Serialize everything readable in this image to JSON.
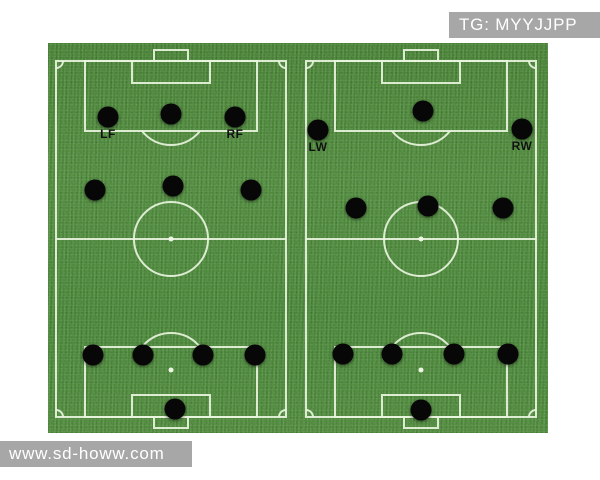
{
  "watermarks": {
    "top_right": "TG: MYYJJPP",
    "bottom_left": "www.sd-howw.com"
  },
  "colors": {
    "grass": "#4e8a3c",
    "pitch_line": "#e8f4dd",
    "player_dot": "#070707",
    "player_label": "#111111",
    "watermark_bg": "#a7a7a7",
    "watermark_text": "#ffffff"
  },
  "field": {
    "width": 500,
    "height": 390
  },
  "pitches": [
    {
      "id": "left",
      "name": "pitch-left-formation",
      "players": [
        {
          "role": "lf",
          "label": "LF",
          "x": 60,
          "y": 74
        },
        {
          "role": "cf",
          "x": 123,
          "y": 71
        },
        {
          "role": "rf",
          "label": "RF",
          "x": 187,
          "y": 74
        },
        {
          "role": "lm",
          "x": 47,
          "y": 147
        },
        {
          "role": "cm",
          "x": 125,
          "y": 143
        },
        {
          "role": "rm",
          "x": 203,
          "y": 147
        },
        {
          "role": "lb",
          "x": 45,
          "y": 312
        },
        {
          "role": "lcb",
          "x": 95,
          "y": 312
        },
        {
          "role": "rcb",
          "x": 155,
          "y": 312
        },
        {
          "role": "rb",
          "x": 207,
          "y": 312
        },
        {
          "role": "gk",
          "x": 127,
          "y": 366
        }
      ]
    },
    {
      "id": "right",
      "name": "pitch-right-formation",
      "players": [
        {
          "role": "lw",
          "label": "LW",
          "x": 270,
          "y": 87
        },
        {
          "role": "cf",
          "x": 375,
          "y": 68
        },
        {
          "role": "rw",
          "label": "RW",
          "x": 474,
          "y": 86
        },
        {
          "role": "lm",
          "x": 308,
          "y": 165
        },
        {
          "role": "cm",
          "x": 380,
          "y": 163
        },
        {
          "role": "rm",
          "x": 455,
          "y": 165
        },
        {
          "role": "lb",
          "x": 295,
          "y": 311
        },
        {
          "role": "lcb",
          "x": 344,
          "y": 311
        },
        {
          "role": "rcb",
          "x": 406,
          "y": 311
        },
        {
          "role": "rb",
          "x": 460,
          "y": 311
        },
        {
          "role": "gk",
          "x": 373,
          "y": 367
        }
      ]
    }
  ]
}
